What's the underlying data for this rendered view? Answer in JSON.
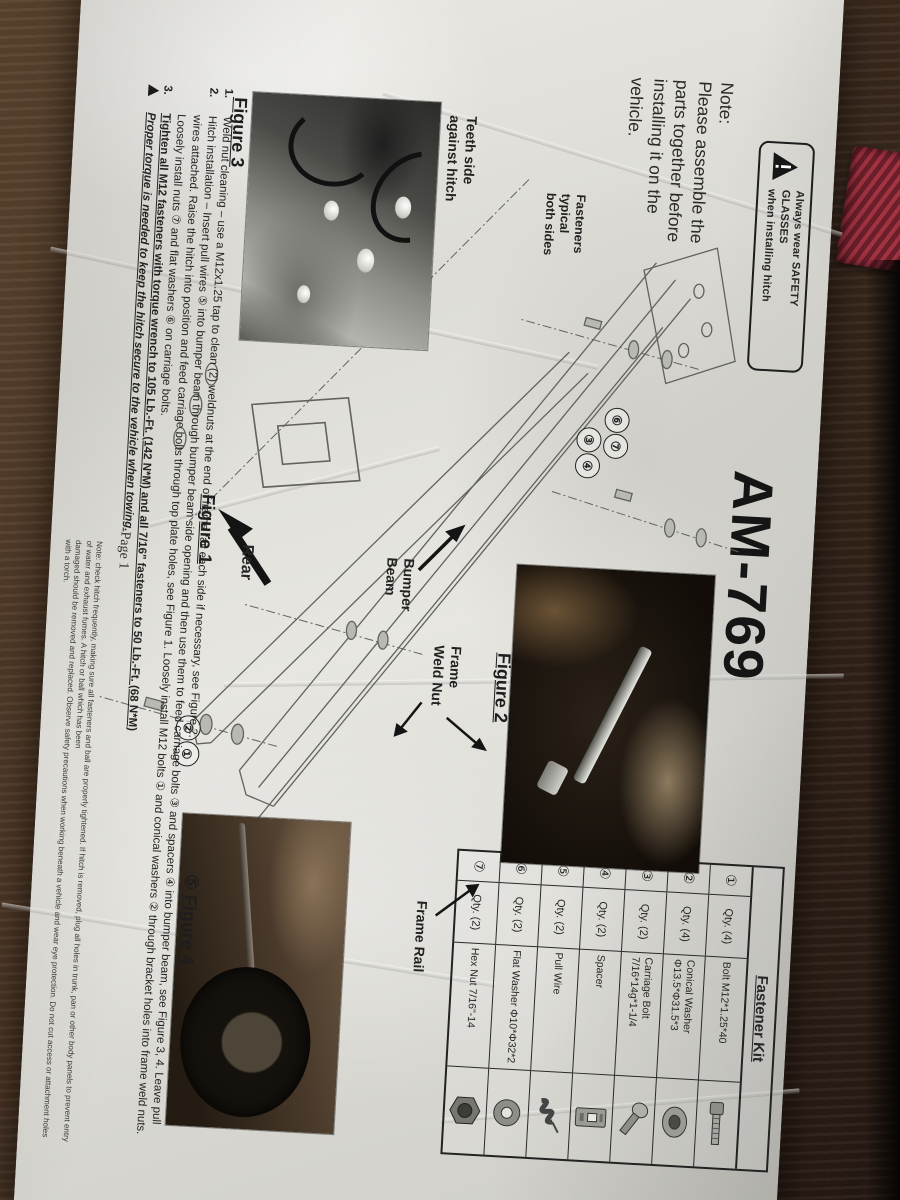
{
  "scene": {
    "description": "Photograph of a crumpled printed hitch installation instruction sheet lying on a dark wood table, page rotated 90 degrees clockwise",
    "colors": {
      "wood": "#4a3525",
      "paper": "#e3e2dc",
      "ink": "#1f1f1f",
      "strap": "#a23442"
    }
  },
  "document": {
    "title": "AM-769",
    "warning_box": {
      "line1": "Always wear SAFETY GLASSES",
      "line2": "when installing hitch"
    },
    "note": {
      "heading": "Note:",
      "line1": "Please assemble the",
      "line2": "parts together before",
      "line3": "installing it on the",
      "line4": "vehicle."
    },
    "fastener_kit": {
      "title": "Fastener Kit",
      "rows": [
        {
          "num": "①",
          "qty": "Qty. (4)",
          "desc": "Bolt M12*1.25*40",
          "icon": "hex-bolt"
        },
        {
          "num": "②",
          "qty": "Qty. (4)",
          "desc": "Conical Washer Φ13.5*Φ31.5*3",
          "icon": "conical-washer"
        },
        {
          "num": "③",
          "qty": "Qty. (2)",
          "desc": "Carriage Bolt 7/16*14g*1-1/4",
          "icon": "carriage-bolt"
        },
        {
          "num": "④",
          "qty": "Qty. (2)",
          "desc": "Spacer",
          "icon": "spacer"
        },
        {
          "num": "⑤",
          "qty": "Qty. (2)",
          "desc": "Pull Wire",
          "icon": "pull-wire"
        },
        {
          "num": "⑥",
          "qty": "Qty. (2)",
          "desc": "Flat Washer Φ10*Φ32*2",
          "icon": "flat-washer"
        },
        {
          "num": "⑦",
          "qty": "Qty. (2)",
          "desc": "Hex Nut 7/16\"-14",
          "icon": "hex-nut"
        }
      ]
    },
    "labels": {
      "teeth_side": "Teeth side\nagainst hitch",
      "fasteners_typical": "Fasteners\ntypical\nboth sides",
      "bumper_beam": "Bumper\nBeam",
      "frame_weld_nut": "Frame\nWeld Nut",
      "frame_rail": "Frame Rail",
      "rear": "Rear"
    },
    "figure_captions": {
      "fig1": "Figure 1",
      "fig2": "Figure 2",
      "fig3": "Figure 3",
      "fig4_prefix": "⑤",
      "fig4": "Figure 4"
    },
    "callouts": {
      "c1": "①",
      "c2": "②",
      "c3": "③",
      "c4": "④",
      "c6": "⑥",
      "c7": "⑦"
    },
    "instructions": {
      "item1_num": "1.",
      "item1": "Weld nut cleaning – use a M12x1.25 tap to clean (2) weldnuts at the end of frame rail each side if necessary, see Figure 2.",
      "item2_num": "2.",
      "item2_line1": "Hitch installation – Insert pull wires ⑤ into bumper beam through bumper beam side opening and then use them to feed carriage bolts ③ and spacers ④ into bumper beam, see Figure 3, 4. Leave pull",
      "item2_line2": "wires attached. Raise the hitch into position and feed carriage bolts through top plate holes, see Figure 1. Loosely install M12 bolts ① and conical washers ② through bracket holes into frame weld nuts.",
      "item2_line3": "Loosely install nuts ⑦ and flat washers ⑥ on carriage bolts.",
      "item3_num": "3.",
      "item3": "Tighten all M12 fasteners with torque wrench to 105 Lb.-Ft. (142 N*M) and all 7/16\" fasteners to 50 Lb.-Ft. (68 N*M)",
      "torque_warning": "Proper torque is needed to keep the hitch secure to the vehicle when towing."
    },
    "fine_print": {
      "line1": "Note: check hitch frequently, making sure all fasteners and ball are properly tightened. If hitch is removed, plug all holes in trunk, pan or other body panels to prevent entry of water and exhaust fumes. A hitch or ball which has been",
      "line2": "damaged should be removed and replaced. Observe safety precautions when working beneath a vehicle and wear eye protection. Do not cut access or attachment holes with a torch."
    },
    "page_number": "Page 1"
  }
}
